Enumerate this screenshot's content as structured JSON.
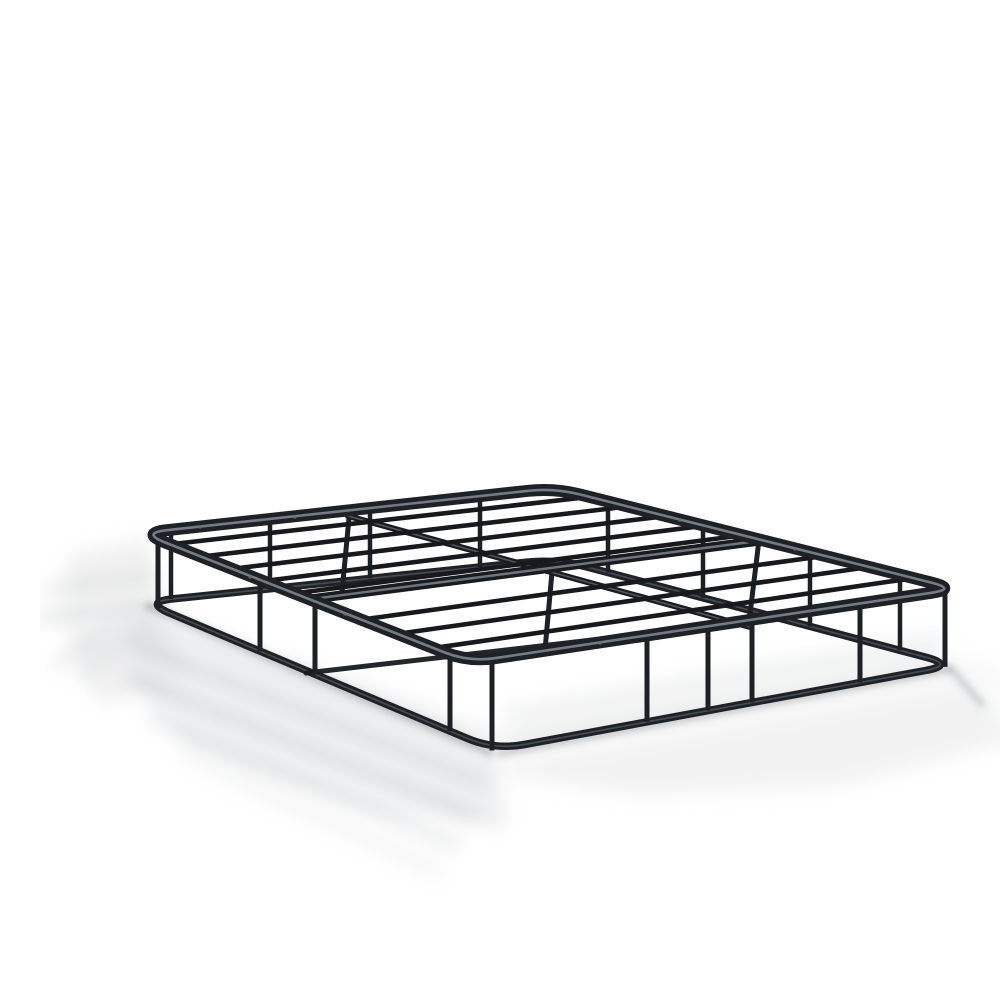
{
  "scene": {
    "description": "Black metal platform bed frame foundation photographed in three-quarter perspective on a seamless white studio background with soft striped floor shadows",
    "canvas": {
      "width": 1000,
      "height": 1000
    },
    "palette": {
      "background": "#ffffff",
      "metal_slat": "#17191d",
      "metal_rim": "#1e2227",
      "metal_rail": "#181b1f",
      "metal_post": "#1d2125",
      "rim_face_highlight": "#9aa1a9",
      "rail_face_highlight": "#848b93",
      "bottom_face_highlight": "#6f767e",
      "screw_dot": "#6a7076",
      "shadow_band": "#c6c9cc",
      "shadow_blob": "#d3d5d7",
      "contact_shadow": "#8d9296",
      "stripe_light": "#ffffff"
    },
    "frame": {
      "top_corners": [
        [
          101,
          517
        ],
        [
          514,
          472
        ],
        [
          917,
          573
        ],
        [
          429,
          646
        ]
      ],
      "bottom_corners": [
        [
          103,
          586
        ],
        [
          517,
          543
        ],
        [
          915,
          649
        ],
        [
          455,
          734
        ]
      ],
      "corner_radius_top": 26,
      "corner_radius_bottom": 30,
      "slat_fractions": [
        0.088,
        0.183,
        0.278,
        0.373,
        0.468,
        0.672,
        0.782,
        0.892
      ],
      "width_rail": [
        [
          718,
          525
        ],
        [
          272,
          583
        ]
      ],
      "length_rail": [
        [
          308,
          500
        ],
        [
          710,
          611
        ]
      ],
      "bottom_width_rail": [
        [
          266,
          657
        ],
        [
          708,
          606
        ]
      ],
      "interior_legs": [
        [
          [
            719,
            524
          ],
          [
            709,
            606
          ]
        ],
        [
          [
            512,
            556
          ],
          [
            505,
            634
          ]
        ],
        [
          [
            309,
            502
          ],
          [
            302,
            576
          ]
        ]
      ],
      "front_left_posts_x": [
        118,
        220,
        275,
        410
      ],
      "front_right_posts_x": [
        452,
        607,
        668,
        712,
        820,
        905
      ],
      "back_left_posts_x": [
        131,
        230,
        330,
        440
      ],
      "back_right_posts_x": [
        568,
        663,
        770,
        860
      ],
      "rim_screw_dots": [
        [
          160,
          511
        ],
        [
          255,
          501
        ],
        [
          640,
          504
        ],
        [
          755,
          533
        ],
        [
          210,
          561
        ],
        [
          305,
          598
        ],
        [
          560,
          627
        ],
        [
          770,
          595
        ]
      ],
      "strokes": {
        "top_rim": 12,
        "rim_highlight": 2.6,
        "slat": 4.6,
        "length_rail": 6,
        "length_rail_highlight": 1.5,
        "width_rail": 9.5,
        "width_rail_highlight": 2.4,
        "bottom_rim": 7.5,
        "bottom_rim_highlight": 1.7,
        "front_post": 5,
        "back_post": 4.5,
        "interior_leg": 5,
        "bottom_width_rail": 5
      }
    },
    "shadow": {
      "blobs": [
        {
          "points": [
            [
              28,
              540
            ],
            [
              108,
              522
            ],
            [
              122,
              596
            ],
            [
              150,
              668
            ],
            [
              60,
              688
            ],
            [
              22,
              610
            ]
          ],
          "opacity": 0.35
        },
        {
          "points": [
            [
              92,
              598
            ],
            [
              300,
              660
            ],
            [
              455,
              718
            ],
            [
              465,
              812
            ],
            [
              330,
              796
            ],
            [
              150,
              736
            ],
            [
              86,
              660
            ]
          ],
          "opacity": 0.4
        },
        {
          "points": [
            [
              458,
              716
            ],
            [
              915,
              643
            ],
            [
              968,
              726
            ],
            [
              800,
              770
            ],
            [
              600,
              780
            ],
            [
              468,
              760
            ]
          ],
          "opacity": 0.3
        }
      ],
      "bands": [
        {
          "from": [
            8,
            574
          ],
          "to": [
            115,
            563
          ],
          "w": 7,
          "opacity": 0.6
        },
        {
          "from": [
            2,
            601
          ],
          "to": [
            125,
            588
          ],
          "w": 9,
          "opacity": 0.6
        },
        {
          "from": [
            98,
            592
          ],
          "to": [
            18,
            648
          ],
          "w": 8,
          "opacity": 0.5
        },
        {
          "from": [
            112,
            602
          ],
          "to": [
            42,
            660
          ],
          "w": 10,
          "opacity": 0.4
        },
        {
          "from": [
            115,
            605
          ],
          "to": [
            430,
            730
          ],
          "w": 8,
          "opacity": 0.5
        },
        {
          "from": [
            100,
            632
          ],
          "to": [
            440,
            768
          ],
          "w": 10,
          "opacity": 0.6
        },
        {
          "from": [
            96,
            664
          ],
          "to": [
            430,
            797
          ],
          "w": 12,
          "opacity": 0.55
        },
        {
          "from": [
            112,
            700
          ],
          "to": [
            415,
            828
          ],
          "w": 12,
          "opacity": 0.4
        },
        {
          "from": [
            140,
            738
          ],
          "to": [
            400,
            856
          ],
          "w": 10,
          "opacity": 0.25
        },
        {
          "from": [
            470,
            700
          ],
          "to": [
            900,
            625
          ],
          "w": 9,
          "opacity": 0.5
        },
        {
          "from": [
            480,
            722
          ],
          "to": [
            890,
            645
          ],
          "w": 8,
          "opacity": 0.4
        },
        {
          "from": [
            920,
            655
          ],
          "to": [
            975,
            715
          ],
          "w": 9,
          "opacity": 0.45
        },
        {
          "from": [
            935,
            648
          ],
          "to": [
            990,
            690
          ],
          "w": 7,
          "opacity": 0.3
        }
      ],
      "lights": [
        {
          "from": [
            20,
            588
          ],
          "to": [
            130,
            575
          ],
          "w": 7,
          "opacity": 0.85
        },
        {
          "from": [
            15,
            612
          ],
          "to": [
            130,
            598
          ],
          "w": 6,
          "opacity": 0.85
        },
        {
          "from": [
            120,
            618
          ],
          "to": [
            435,
            742
          ],
          "w": 6,
          "opacity": 0.8
        },
        {
          "from": [
            95,
            646
          ],
          "to": [
            440,
            782
          ],
          "w": 7,
          "opacity": 0.85
        },
        {
          "from": [
            90,
            680
          ],
          "to": [
            425,
            812
          ],
          "w": 8,
          "opacity": 0.85
        },
        {
          "from": [
            105,
            718
          ],
          "to": [
            410,
            842
          ],
          "w": 9,
          "opacity": 0.9
        },
        {
          "from": [
            475,
            712
          ],
          "to": [
            895,
            636
          ],
          "w": 6,
          "opacity": 0.8
        },
        {
          "from": [
            462,
            745
          ],
          "to": [
            925,
            664
          ],
          "w": 8,
          "opacity": 0.85
        },
        {
          "from": [
            930,
            662
          ],
          "to": [
            982,
            722
          ],
          "w": 6,
          "opacity": 0.8
        }
      ],
      "contacts": [
        {
          "from": [
            108,
            590
          ],
          "to": [
            450,
            736
          ],
          "w": 7,
          "opacity": 0.55
        },
        {
          "from": [
            460,
            737
          ],
          "to": [
            910,
            653
          ],
          "w": 6,
          "opacity": 0.5
        },
        {
          "from": [
            910,
            652
          ],
          "to": [
            942,
            688
          ],
          "w": 6,
          "opacity": 0.4
        }
      ]
    }
  }
}
